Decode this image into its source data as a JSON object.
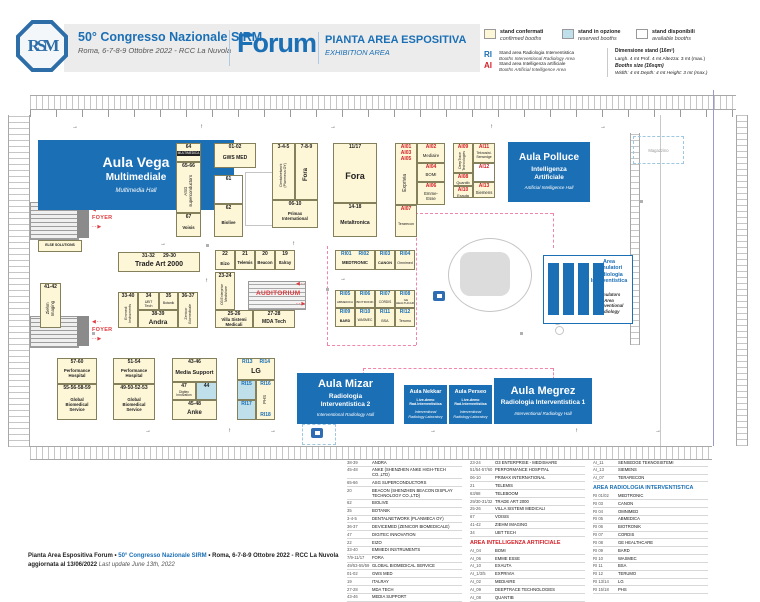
{
  "header": {
    "logo": "RSM",
    "congress": "50° Congresso Nazionale SIRM",
    "date": "Roma, 6-7-8-9 Ottobre 2022 - RCC La Nuvola",
    "venue": "Forum",
    "title": "PIANTA AREA ESPOSITIVA",
    "subtitle": "EXHIBITION AREA"
  },
  "legend": {
    "confirmed": {
      "label": "stand confermati",
      "sub": "confirmed booths"
    },
    "reserved": {
      "label": "stand in opzione",
      "sub": "reserved booths"
    },
    "available": {
      "label": "stand disponibili",
      "sub": "available booths"
    },
    "ri": {
      "code": "RI",
      "label": "Stand area Radiologia Interventistica",
      "sub": "Booths Interventional Radiology Area"
    },
    "ai": {
      "code": "AI",
      "label": "Stand area Intelligenza artificiale",
      "sub": "Booths Artificial Intelligence Area"
    },
    "dim_title": "Dimensione stand (16m²)",
    "dim_line": "Largh. 4 mt   Prof. 4 mt   Altezza: 3 mt (max.)",
    "size_title": "Booths size (16sqm)",
    "size_line": "Width: 4 mt   Depth: 4 mt   Height: 3 mt (max.)"
  },
  "colors": {
    "brand": "#1b6fb5",
    "red": "#d42027",
    "confirmed": "#fdf6d7",
    "reserved": "#bfe0ea",
    "pink_dash": "#f286a8"
  },
  "map_labels": {
    "foyer": "FOYER",
    "auditorium": "AUDITORIUM",
    "magazzino": "Magazzino"
  },
  "map": {
    "halls": [
      {
        "id": "vega",
        "t": "Aula Vega",
        "s": "Multimediale",
        "e": "Multimedia Hall",
        "x": 38,
        "y": 140,
        "w": 196,
        "h": 70,
        "tf": 14,
        "sf": 10,
        "ef": 6
      },
      {
        "id": "polluce",
        "t": "Aula Polluce",
        "s": "Intelligenza\nArtificiale",
        "e": "Artificial Intelligence Hall",
        "x": 508,
        "y": 142,
        "w": 82,
        "h": 60,
        "tf": 10,
        "sf": 6.5,
        "ef": 4.5
      },
      {
        "id": "mizar",
        "t": "Aula Mizar",
        "s": "Radiologia\nInterventistica 2",
        "e": "Interventional Radiology Hall",
        "x": 297,
        "y": 373,
        "w": 97,
        "h": 51,
        "tf": 11,
        "sf": 6.5,
        "ef": 4.5
      },
      {
        "id": "nekkar",
        "t": "Aula Nekkar",
        "s": "Live-demo\nRad.Interventistica",
        "e": "Interventional\nRadiology Laboratory",
        "x": 404,
        "y": 385,
        "w": 43,
        "h": 39,
        "tf": 5.5,
        "sf": 3.6,
        "ef": 3.6
      },
      {
        "id": "perseo",
        "t": "Aula Perseo",
        "s": "Live-demo\nRad.Interventistica",
        "e": "Interventional\nRadiology Laboratory",
        "x": 449,
        "y": 385,
        "w": 43,
        "h": 39,
        "tf": 5.5,
        "sf": 3.6,
        "ef": 3.6
      },
      {
        "id": "megrez",
        "t": "Aula Megrez",
        "s": "Radiologia Interventistica 1",
        "e": "Interventional Radiology Hall",
        "x": 494,
        "y": 378,
        "w": 98,
        "h": 46,
        "tf": 11,
        "sf": 6.5,
        "ef": 4.5
      }
    ],
    "simulatori": {
      "title": "Area\nSimulatori\nRadiologia\nInterventistica",
      "en": "Simulators\nArea\nInterventional\nRadiology"
    },
    "booths": [
      {
        "c": "64",
        "n": "MULTIMEDICA",
        "x": 176,
        "y": 143,
        "w": 25,
        "h": 19,
        "dk": 1
      },
      {
        "c": "65-66",
        "n": "ASG\nsuperconductors",
        "x": 176,
        "y": 162,
        "w": 25,
        "h": 51,
        "v": 1
      },
      {
        "c": "67",
        "n": "Voisis",
        "x": 176,
        "y": 213,
        "w": 25,
        "h": 24,
        "nb": 1
      },
      {
        "c": "01-02",
        "n": "GWS MED",
        "x": 214,
        "y": 143,
        "w": 42,
        "h": 25,
        "nb": 1,
        "nf": 5
      },
      {
        "c": "61",
        "n": "",
        "x": 214,
        "y": 175,
        "w": 29,
        "h": 29,
        "st": "a"
      },
      {
        "c": "62",
        "n": "Biolive",
        "x": 214,
        "y": 204,
        "w": 29,
        "h": 33,
        "nb": 1
      },
      {
        "c": "3-4-5",
        "n": "Dentalnetwork\n(Planmeca OY)",
        "x": 272,
        "y": 143,
        "w": 23,
        "h": 57,
        "v": 1,
        "nf": 3.6
      },
      {
        "c": "7-8-9",
        "n": "Fora",
        "x": 295,
        "y": 143,
        "w": 23,
        "h": 57,
        "v": 1,
        "nb": 1,
        "nf": 6
      },
      {
        "c": "06-10",
        "n": "Primax\nInternational",
        "x": 272,
        "y": 200,
        "w": 46,
        "h": 28,
        "nb": 1
      },
      {
        "c": "11/17",
        "n": "Fora",
        "x": 333,
        "y": 143,
        "w": 44,
        "h": 60,
        "nb": 1,
        "nf": 9
      },
      {
        "c": "14-18",
        "n": "Metaltronica",
        "x": 333,
        "y": 203,
        "w": 44,
        "h": 34,
        "nb": 1,
        "nf": 5
      },
      {
        "c": "AI01\nAI03\nAI05",
        "n": "Exprivia",
        "x": 395,
        "y": 143,
        "w": 22,
        "h": 62,
        "v": 1,
        "cc": "r",
        "nf": 5
      },
      {
        "c": "AI07",
        "n": "Terarecon",
        "x": 395,
        "y": 205,
        "w": 22,
        "h": 32,
        "cc": "r",
        "nf": 3.6
      },
      {
        "c": "AI02",
        "n": "Mediaire",
        "x": 417,
        "y": 143,
        "w": 28,
        "h": 20,
        "cc": "r"
      },
      {
        "c": "AI04",
        "n": "BOMI",
        "x": 417,
        "y": 163,
        "w": 28,
        "h": 19,
        "cc": "r"
      },
      {
        "c": "AI06",
        "n": "Emme-\nEsse",
        "x": 417,
        "y": 182,
        "w": 28,
        "h": 23,
        "cc": "r"
      },
      {
        "c": "AI09",
        "n": "DeepTrace\nTechnologies",
        "x": 453,
        "y": 143,
        "w": 20,
        "h": 30,
        "v": 1,
        "cc": "r",
        "nf": 3.4
      },
      {
        "c": "AI08",
        "n": "Quantib",
        "x": 453,
        "y": 173,
        "w": 20,
        "h": 13,
        "cc": "r",
        "nf": 3.8
      },
      {
        "c": "AI10",
        "n": "Exauta",
        "x": 453,
        "y": 186,
        "w": 20,
        "h": 12,
        "cc": "r",
        "nf": 3.8
      },
      {
        "c": "AI11",
        "n": "Teknosist.\nSensedge",
        "x": 473,
        "y": 143,
        "w": 22,
        "h": 20,
        "cc": "r",
        "nf": 3.4
      },
      {
        "c": "AI12",
        "n": "",
        "x": 473,
        "y": 163,
        "w": 22,
        "h": 19,
        "st": "a",
        "cc": "r"
      },
      {
        "c": "AI13",
        "n": "Siemens",
        "x": 473,
        "y": 182,
        "w": 22,
        "h": 16,
        "cc": "r"
      },
      {
        "c": "31-32      29-30",
        "n": "Trade Art 2000",
        "x": 118,
        "y": 252,
        "w": 82,
        "h": 20,
        "nb": 1,
        "nf": 7
      },
      {
        "c": "41-42",
        "n": "Ziehm\nImaging",
        "x": 40,
        "y": 283,
        "w": 21,
        "h": 45,
        "v": 1
      },
      {
        "c": "33-40",
        "n": "Emmedi\nInstruments",
        "x": 118,
        "y": 292,
        "w": 20,
        "h": 36,
        "v": 1,
        "nf": 3.6
      },
      {
        "c": "34",
        "n": "UBT\nTech",
        "x": 138,
        "y": 292,
        "w": 21,
        "h": 18,
        "nf": 3.8
      },
      {
        "c": "35",
        "n": "Botanik",
        "x": 159,
        "y": 292,
        "w": 19,
        "h": 18,
        "nf": 3.4
      },
      {
        "c": "36-37",
        "n": "Zenicor\nBiomedicale",
        "x": 178,
        "y": 292,
        "w": 20,
        "h": 36,
        "v": 1,
        "nf": 3.6
      },
      {
        "c": "38-39",
        "n": "Andra",
        "x": 138,
        "y": 310,
        "w": 40,
        "h": 18,
        "nb": 1,
        "nf": 6.5
      },
      {
        "c": "22",
        "n": "Eizo",
        "x": 215,
        "y": 250,
        "w": 20,
        "h": 20,
        "nb": 1,
        "nf": 4.5
      },
      {
        "c": "21",
        "n": "Telemis",
        "x": 235,
        "y": 250,
        "w": 20,
        "h": 20,
        "nb": 1,
        "nf": 4.2
      },
      {
        "c": "20",
        "n": "Beacon",
        "x": 255,
        "y": 250,
        "w": 20,
        "h": 20,
        "nb": 1,
        "nf": 4.2
      },
      {
        "c": "19",
        "n": "Italray",
        "x": 275,
        "y": 250,
        "w": 20,
        "h": 20,
        "nb": 1,
        "nf": 4.2
      },
      {
        "c": "23-24",
        "n": "O3 Enterprise\nMedishare",
        "x": 215,
        "y": 272,
        "w": 20,
        "h": 38,
        "v": 1,
        "nf": 3.4
      },
      {
        "c": "25-26",
        "n": "Villa Sistemi\nMedicali",
        "x": 215,
        "y": 310,
        "w": 38,
        "h": 18,
        "nb": 1
      },
      {
        "c": "27-28",
        "n": "MDA Tech",
        "x": 253,
        "y": 310,
        "w": 42,
        "h": 18,
        "nb": 1,
        "nf": 5
      },
      {
        "c": "RI01     RI02",
        "n": "MEDTRONIC",
        "x": 335,
        "y": 250,
        "w": 40,
        "h": 20,
        "cc": "b",
        "nb": 1
      },
      {
        "c": "RI03",
        "n": "CANON",
        "x": 375,
        "y": 250,
        "w": 20,
        "h": 20,
        "cc": "b",
        "nb": 1,
        "nf": 3.8
      },
      {
        "c": "RI04",
        "n": "Omnimed",
        "x": 395,
        "y": 250,
        "w": 20,
        "h": 20,
        "cc": "b",
        "nf": 3.6
      },
      {
        "c": "RI05",
        "n": "ABMEDICA",
        "x": 335,
        "y": 290,
        "w": 20,
        "h": 18,
        "cc": "b",
        "nf": 3.1
      },
      {
        "c": "RI06",
        "n": "BIOTRONIK",
        "x": 355,
        "y": 290,
        "w": 20,
        "h": 18,
        "cc": "b",
        "nf": 3.1
      },
      {
        "c": "RI07",
        "n": "CORDIS",
        "x": 375,
        "y": 290,
        "w": 20,
        "h": 18,
        "cc": "b",
        "nf": 3.2
      },
      {
        "c": "RI08",
        "n": "GE\nHEALTHCARE",
        "x": 395,
        "y": 290,
        "w": 20,
        "h": 18,
        "cc": "b",
        "nf": 3
      },
      {
        "c": "RI09",
        "n": "BARD",
        "x": 335,
        "y": 308,
        "w": 20,
        "h": 19,
        "cc": "b",
        "nb": 1,
        "nf": 3.6
      },
      {
        "c": "RI10",
        "n": "WASMEC",
        "x": 355,
        "y": 308,
        "w": 20,
        "h": 19,
        "cc": "b",
        "nf": 3.3
      },
      {
        "c": "RI11",
        "n": "BSA",
        "x": 375,
        "y": 308,
        "w": 20,
        "h": 19,
        "cc": "b",
        "nf": 3.6
      },
      {
        "c": "RI12",
        "n": "Terumo",
        "x": 395,
        "y": 308,
        "w": 20,
        "h": 19,
        "cc": "b",
        "nf": 3.6
      },
      {
        "c": "57-60",
        "n": "Performance\nHospital",
        "x": 57,
        "y": 358,
        "w": 40,
        "h": 26,
        "nb": 1
      },
      {
        "c": "55-56-58-59",
        "n": "Global\nBiomedical\nService",
        "x": 57,
        "y": 384,
        "w": 40,
        "h": 36,
        "nb": 1
      },
      {
        "c": "51-54",
        "n": "Performance\nHospital",
        "x": 113,
        "y": 358,
        "w": 42,
        "h": 26,
        "nb": 1
      },
      {
        "c": "49-50-52-53",
        "n": "Global\nBiomedical\nService",
        "x": 113,
        "y": 384,
        "w": 42,
        "h": 36,
        "nb": 1
      },
      {
        "c": "43-46",
        "n": "Media Support",
        "x": 172,
        "y": 358,
        "w": 45,
        "h": 24,
        "nb": 1,
        "nf": 5.5
      },
      {
        "c": "47",
        "n": "Digitec\nInnovation",
        "x": 172,
        "y": 382,
        "w": 24,
        "h": 18,
        "nf": 3.3
      },
      {
        "c": "44",
        "n": "",
        "x": 196,
        "y": 382,
        "w": 21,
        "h": 18,
        "st": "o"
      },
      {
        "c": "45-48",
        "n": "Anke",
        "x": 172,
        "y": 400,
        "w": 45,
        "h": 20,
        "nb": 1,
        "nf": 6
      },
      {
        "c": "RI13     RI14",
        "n": "LG",
        "x": 237,
        "y": 358,
        "w": 38,
        "h": 22,
        "cc": "b",
        "nb": 1,
        "nf": 7
      },
      {
        "c": "RI15",
        "n": "",
        "x": 237,
        "y": 380,
        "w": 19,
        "h": 20,
        "st": "o",
        "cc": "b"
      },
      {
        "c": "RI17",
        "n": "",
        "x": 237,
        "y": 400,
        "w": 19,
        "h": 20,
        "st": "o",
        "cc": "b"
      },
      {
        "c": "RI16",
        "c2": "RI18",
        "n": "PHS",
        "x": 256,
        "y": 380,
        "w": 19,
        "h": 40,
        "v": 1,
        "cc": "b"
      },
      {
        "c": "",
        "n": "ELSE SOLUTIONS",
        "x": 38,
        "y": 240,
        "w": 44,
        "h": 12,
        "nb": 1,
        "nf": 3.4
      }
    ]
  },
  "directory": {
    "columns": [
      {
        "blocks": [
          {
            "rows": [
              [
                "38-39",
                "ANDRA"
              ],
              [
                "45-48",
                "ANKE (SHENZHEN ANKE HIGH-TECH CO.,LTD)"
              ],
              [
                "65-66",
                "ASG SUPERCONDUCTORS"
              ],
              [
                "20",
                "BEACON (SHENZHEN BEACON DISPLAY TECHNOLOGY CO.,LTD)"
              ],
              [
                "62",
                "BIOLIVE"
              ],
              [
                "35",
                "BOTANIK"
              ],
              [
                "3-4-5",
                "DENTALNETWORK (PLANMECA OY)"
              ],
              [
                "36-37",
                "DEVICEMED (ZENICOR BIOMEDICALE)"
              ],
              [
                "47",
                "DIGITEC INNOVATION"
              ],
              [
                "22",
                "EIZO"
              ],
              [
                "33-40",
                "EMMEDI INSTRUMENTS"
              ],
              [
                "7/9-11/17",
                "FORA"
              ],
              [
                "49/53-55/59",
                "GLOBAL BIOMEDICAL SERVICE"
              ],
              [
                "01-02",
                "GWS MED"
              ],
              [
                "19",
                "ITALRAY"
              ],
              [
                "27-28",
                "MDA TECH"
              ],
              [
                "43-46",
                "MEDIA SUPPORT"
              ],
              [
                "14-18",
                "METALTRONICA"
              ],
              [
                "64",
                "MULTIMEDICA"
              ]
            ]
          }
        ]
      },
      {
        "blocks": [
          {
            "rows": [
              [
                "23-24",
                "O3 ENTERPRISE - MEDISHARE"
              ],
              [
                "51/54-57/60",
                "PERFORMANCE HOSPITAL"
              ],
              [
                "06-10",
                "PRIMAX INTERNATIONAL"
              ],
              [
                "21",
                "TELEMIS"
              ],
              [
                "63/68",
                "TELEBOOM"
              ],
              [
                "29/30-31/32",
                "TRADE ART 2000"
              ],
              [
                "25-26",
                "VILLA SISTEMI MEDICALI"
              ],
              [
                "67",
                "VOISIS"
              ],
              [
                "41-42",
                "ZIEHM IMAGING"
              ],
              [
                "34",
                "UBT TECH"
              ]
            ]
          },
          {
            "heading": "AREA INTELLIGENZA ARTIFICIALE",
            "style": "red"
          },
          {
            "rows": [
              [
                "AI_04",
                "BOMI"
              ],
              [
                "AI_06",
                "EMME ESSE"
              ],
              [
                "AI_10",
                "EXAUTA"
              ],
              [
                "AI_1/3/5",
                "EXPRIVIA"
              ],
              [
                "AI_02",
                "MEDIAIRE"
              ],
              [
                "AI_09",
                "DEEPTRACE TECHNOLOGIES"
              ],
              [
                "AI_08",
                "QUANTIB"
              ]
            ]
          }
        ]
      },
      {
        "blocks": [
          {
            "rows": [
              [
                "AI_11",
                "SENSEDGE TEKNOSISTEMI"
              ],
              [
                "AI_13",
                "SIEMENS"
              ],
              [
                "AI_07",
                "TERARECON"
              ]
            ]
          },
          {
            "heading": "AREA RADIOLOGIA INTERVENTISTICA",
            "style": "blue"
          },
          {
            "rows": [
              [
                "RI 01/02",
                "MEDTRONIC"
              ],
              [
                "RI 03",
                "CANON"
              ],
              [
                "RI 04",
                "OMNIMED"
              ],
              [
                "RI 05",
                "ABMEDICA"
              ],
              [
                "RI 06",
                "BIOTRONIK"
              ],
              [
                "RI 07",
                "CORDIS"
              ],
              [
                "RI 08",
                "GE HEALTHCARE"
              ],
              [
                "RI 09",
                "BARD"
              ],
              [
                "RI 10",
                "WASMEC"
              ],
              [
                "RI 11",
                "BSA"
              ],
              [
                "RI 12",
                "TERUMO"
              ],
              [
                "RI 13/14",
                "LG"
              ],
              [
                "RI 15/18",
                "PHS"
              ]
            ]
          }
        ]
      }
    ]
  },
  "footer": {
    "line1_a": "Pianta Area Espositiva Forum • ",
    "line1_b": "50° Congresso Nazionale SIRM",
    "line1_c": " • Roma, 6-7-8-9 Ottobre 2022 - RCC La Nuvola",
    "line2_a": "aggiornata al 13/06/2022 ",
    "line2_b": "Last update June 13th, 2022"
  }
}
